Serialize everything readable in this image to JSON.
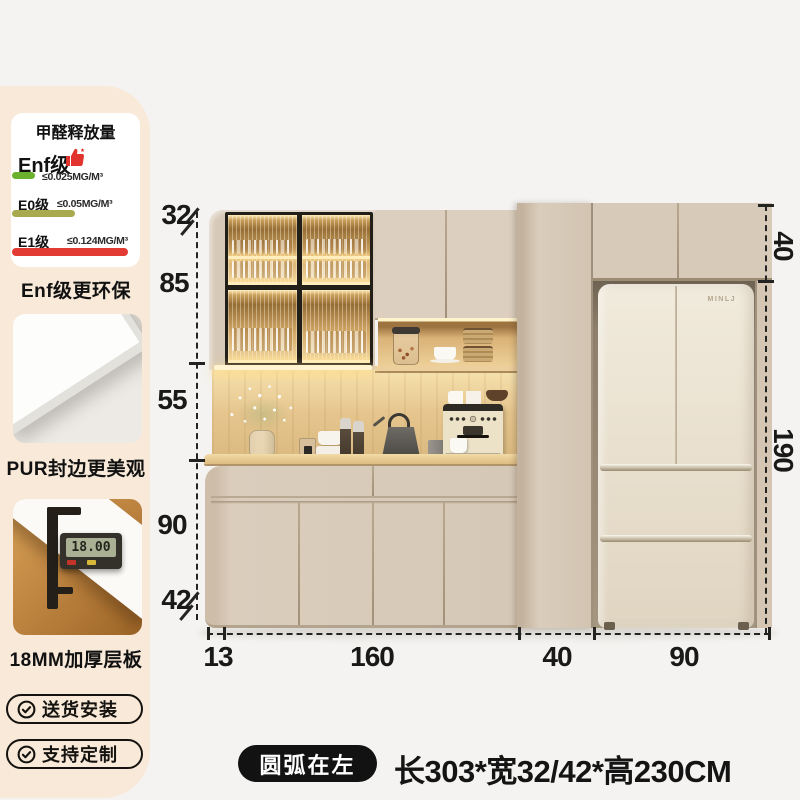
{
  "sidebar": {
    "env_card": {
      "title": "甲醛释放量",
      "grades": [
        {
          "name": "Enf级",
          "limit": "≤0.025MG/M³",
          "bar_color": "#6ab12d"
        },
        {
          "name": "E0级",
          "limit": "≤0.05MG/M³",
          "bar_color": "#a9aa50"
        },
        {
          "name": "E1级",
          "limit": "≤0.124MG/M³",
          "bar_color": "#e23b34"
        }
      ]
    },
    "captions": {
      "env": "Enf级更环保",
      "edge": "PUR封边更美观",
      "board": "18MM加厚层板"
    },
    "caliper_reading": "18.00",
    "badges": [
      {
        "label": "送货安装"
      },
      {
        "label": "支持定制"
      }
    ],
    "panel_color": "#f8e9d8"
  },
  "diagram": {
    "fridge_logo": "MINLJ",
    "left_dims": [
      "32",
      "85",
      "55",
      "90",
      "42"
    ],
    "right_dims": [
      "40",
      "190"
    ],
    "bottom_dims": [
      "13",
      "160",
      "40",
      "90"
    ],
    "cabinet_color": "#d7c9b7",
    "wood_color": "#e6c68e",
    "fridge_color": "#ece4d4"
  },
  "footer": {
    "shape_badge": "圆弧在左",
    "size_text": "长303*宽32/42*高230CM"
  }
}
